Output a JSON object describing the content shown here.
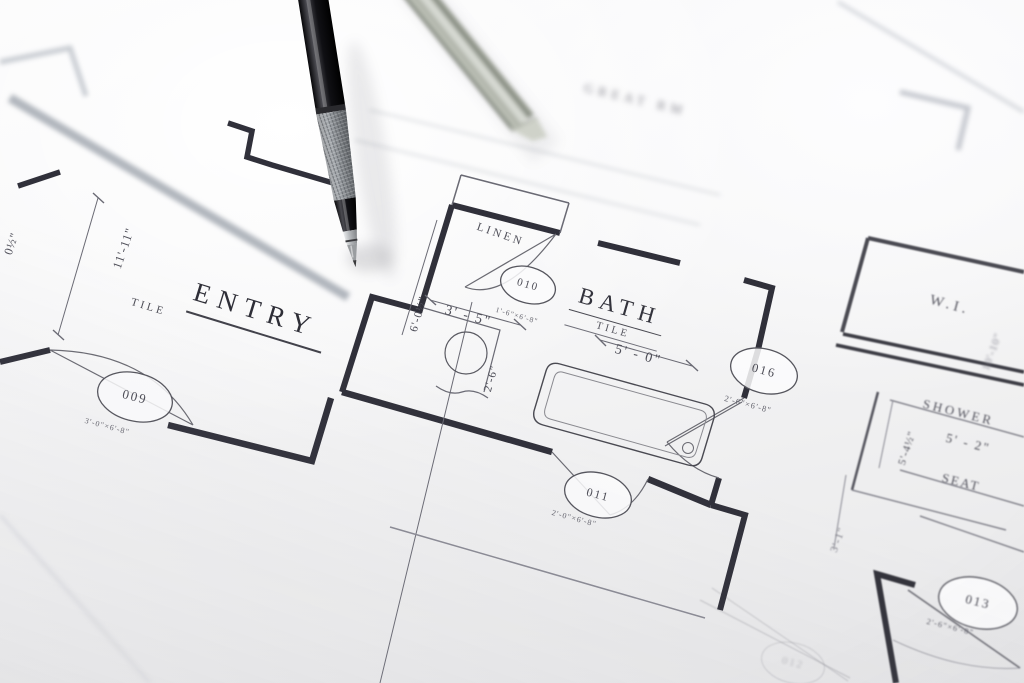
{
  "scene": {
    "type": "photograph",
    "subject": "architectural floor plan blueprint with mechanical drafting pencil and metal scale ruler"
  },
  "rooms": {
    "entry": {
      "label": "ENTRY",
      "finish": "TILE"
    },
    "bath": {
      "label": "BATH",
      "finish": "TILE"
    },
    "linen": {
      "label": "LINEN"
    },
    "walk_in": {
      "label": "W.I."
    },
    "shower": {
      "label": "SHOWER"
    },
    "seat": {
      "label": "SEAT"
    },
    "great_room": {
      "label": "GREAT RM"
    }
  },
  "door_markers": {
    "m009": {
      "number": "009",
      "size": "3'-0\"×6'-8\""
    },
    "m010": {
      "number": "010",
      "size": "1'-6\"×6'-8\""
    },
    "m011": {
      "number": "011",
      "size": "2'-0\"×6'-8\""
    },
    "m016": {
      "number": "016",
      "size": "2'-6\"×6'-8\""
    },
    "m013": {
      "number": "013",
      "size": "2'-6\"×6'-8\""
    },
    "m012": {
      "number": "012",
      "size": ""
    }
  },
  "dimensions": {
    "entry_wall": "11'-11\"",
    "edge_partial": "0½\"",
    "vanity_nook_width": "3' - 5\"",
    "bath_length": "6'-0½\"",
    "vanity_depth": "2'-6\"",
    "tub_length": "5' - 0\"",
    "shower_width": "5' - 2\"",
    "shower_depth": "5'-4½\"",
    "hall_width": "3'-1\"",
    "closet_depth": "10'-10\""
  }
}
